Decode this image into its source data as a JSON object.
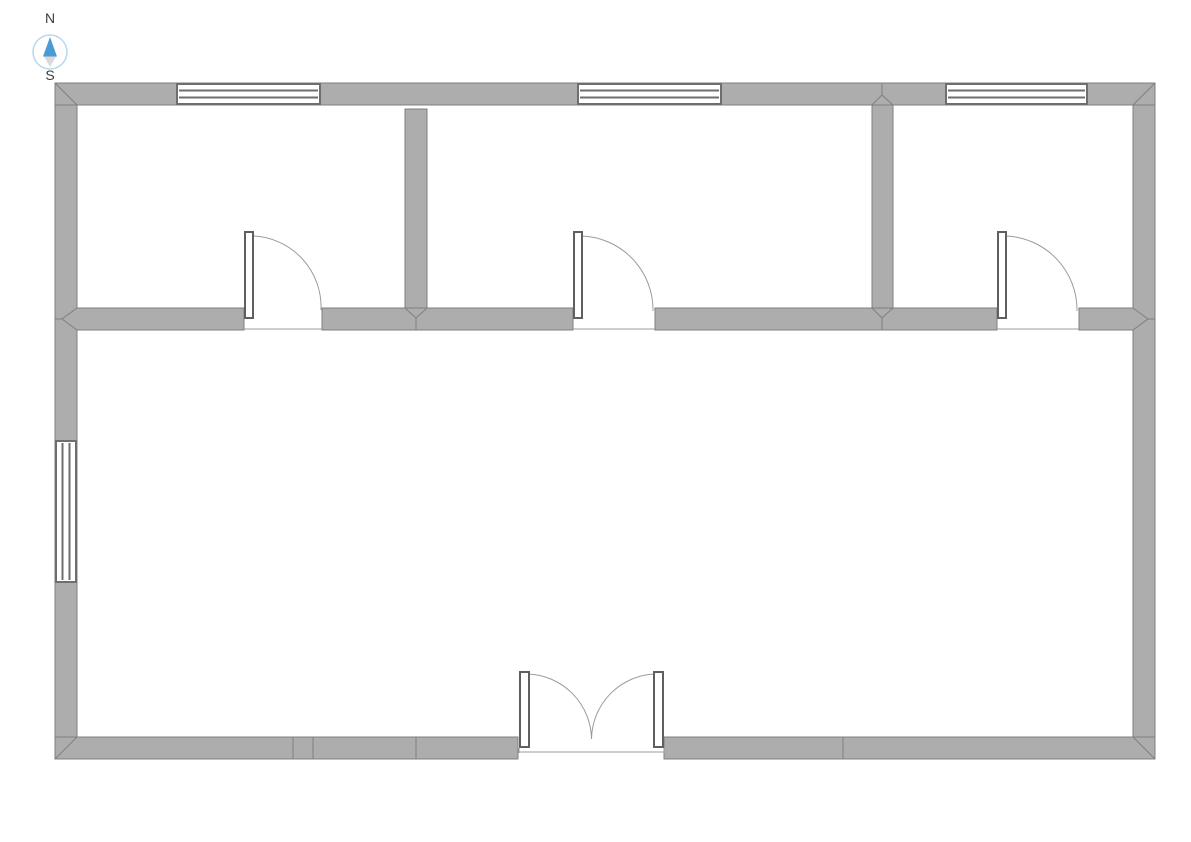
{
  "scene": {
    "canvas_width": 1191,
    "canvas_height": 842,
    "background": "#ffffff",
    "wall_thickness_px": 22
  },
  "compass": {
    "north_label": "N",
    "south_label": "S"
  },
  "colors": {
    "wall_fill": "#adadad",
    "wall_stroke": "#7f7f7f",
    "window_stroke": "#6e6e6e",
    "door_stroke": "#5f5f5f",
    "arc_stroke": "#9b9b9b",
    "compass_ring": "#b9d8ec",
    "compass_north": "#4a9bd5",
    "compass_south": "#d9d9d9",
    "label_color": "#3c3c3c"
  },
  "floorplan": {
    "outer_walls": {
      "x": 55,
      "y": 83,
      "width": 1100,
      "height": 676
    },
    "interior_walls": [
      {
        "id": "divider-horizontal",
        "orientation": "horizontal",
        "y_top": 308,
        "y_bottom": 330,
        "from_x": 55,
        "to_x": 1155,
        "door_openings": 3
      },
      {
        "id": "divider-vertical-1",
        "orientation": "vertical",
        "x_left": 405,
        "x_right": 427,
        "from_y": 109,
        "to_y": 330
      },
      {
        "id": "divider-vertical-2",
        "orientation": "vertical",
        "x_left": 872,
        "x_right": 893,
        "from_y": 83,
        "to_y": 330
      }
    ],
    "wall_seams_bottom_x": [
      293,
      313,
      416,
      843
    ],
    "windows": [
      {
        "id": "window-north-1",
        "wall": "north",
        "x": 177,
        "y": 84,
        "width": 143,
        "height": 20,
        "panes": 3
      },
      {
        "id": "window-north-2",
        "wall": "north",
        "x": 578,
        "y": 84,
        "width": 143,
        "height": 20,
        "panes": 3
      },
      {
        "id": "window-north-3",
        "wall": "north",
        "x": 946,
        "y": 84,
        "width": 141,
        "height": 20,
        "panes": 3
      },
      {
        "id": "window-west",
        "wall": "west",
        "x": 56,
        "y": 441,
        "width": 20,
        "height": 141,
        "panes": 3
      }
    ],
    "doors": [
      {
        "id": "door-room-1",
        "type": "single",
        "hinge": "left",
        "swings": "into-north-room",
        "opening_x": 244,
        "opening_end_x": 322,
        "wall_y": 308
      },
      {
        "id": "door-room-2",
        "type": "single",
        "hinge": "left",
        "swings": "into-north-room",
        "opening_x": 573,
        "opening_end_x": 655,
        "wall_y": 308
      },
      {
        "id": "door-room-3",
        "type": "single",
        "hinge": "left",
        "swings": "into-north-room",
        "opening_x": 997,
        "opening_end_x": 1079,
        "wall_y": 308
      },
      {
        "id": "door-entrance-double",
        "type": "double",
        "swings": "inward",
        "opening_x": 518,
        "opening_end_x": 664,
        "wall_y": 737
      }
    ],
    "rooms": {
      "north_room_count": 3,
      "south_room_count": 1
    }
  }
}
